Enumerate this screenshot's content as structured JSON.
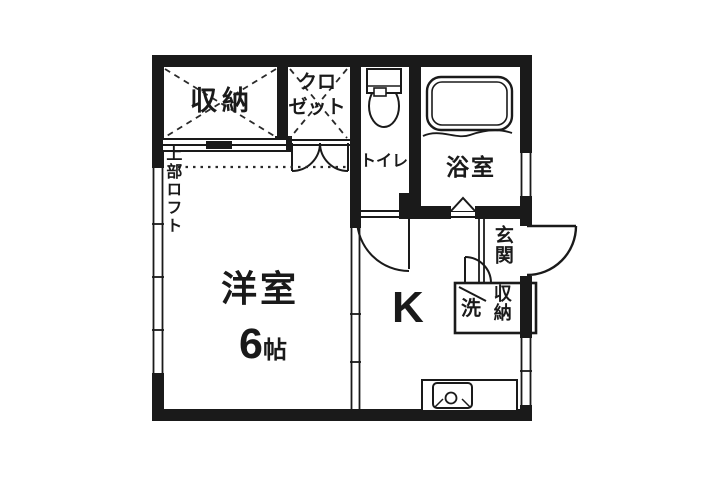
{
  "colors": {
    "line": "#1a1a1a",
    "background": "#ffffff"
  },
  "rooms": {
    "storage_top": {
      "label": "収納"
    },
    "closet": {
      "label_line1": "クロ",
      "label_line2": "ゼット"
    },
    "toilet": {
      "label": "トイレ"
    },
    "bathroom": {
      "label": "浴室"
    },
    "western_room": {
      "label": "洋室",
      "size_number": "6",
      "size_unit": "帖"
    },
    "kitchen": {
      "label": "K"
    },
    "entrance": {
      "label": "玄関"
    },
    "laundry": {
      "label": "洗"
    },
    "entrance_storage": {
      "label": "収納"
    },
    "loft_note": {
      "label": "上部ロフト"
    }
  },
  "fixtures": {
    "toilet_icon": "toilet-top-view",
    "bathtub_icon": "bathtub-top-view",
    "sink_icon": "kitchen-sink-counter"
  }
}
